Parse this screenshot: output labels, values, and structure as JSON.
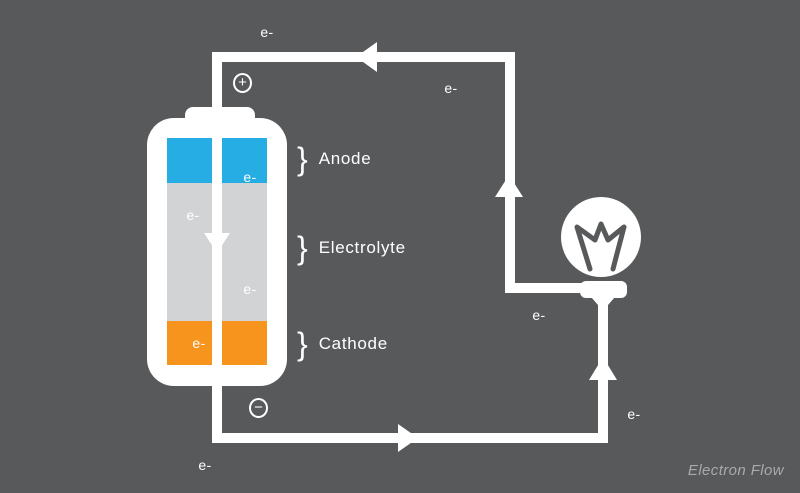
{
  "diagram": {
    "caption": "Electron Flow",
    "electron_label": "e-",
    "terminals": {
      "positive": "+",
      "negative": "−"
    },
    "battery": {
      "brace": "}",
      "sections": [
        {
          "name": "Anode",
          "color": "#25ade4"
        },
        {
          "name": "Electrolyte",
          "color": "#d2d3d5"
        },
        {
          "name": "Cathode",
          "color": "#f7941e"
        }
      ]
    },
    "colors": {
      "background": "#58595b",
      "wire": "#ffffff",
      "label_text": "#ffffff",
      "caption_text": "#a8aaac"
    }
  }
}
